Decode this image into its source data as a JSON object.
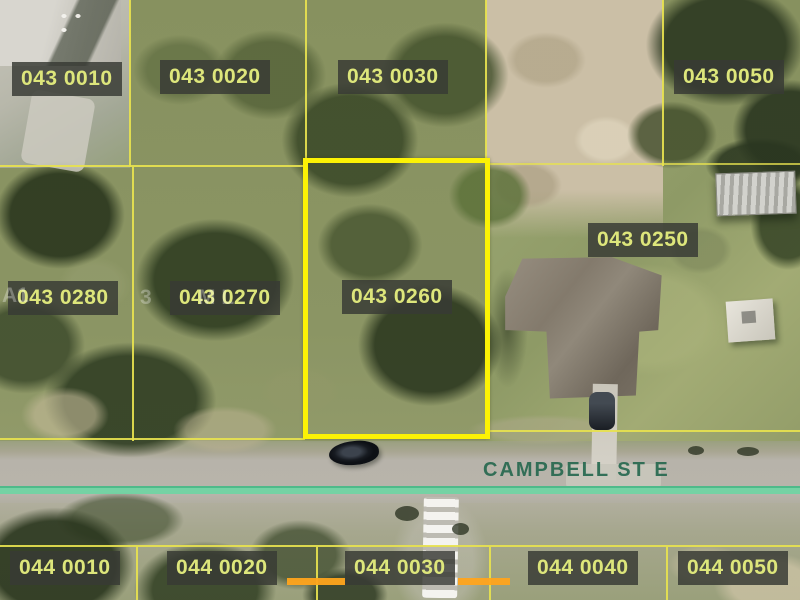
{
  "map": {
    "description": "Aerial parcel map with lot boundaries",
    "street": {
      "name": "CAMPBELL ST E"
    },
    "selected_parcel": {
      "id": "043 0260"
    },
    "parcels": [
      {
        "id": "043 0010"
      },
      {
        "id": "043 0020"
      },
      {
        "id": "043 0030"
      },
      {
        "id": "043 0050"
      },
      {
        "id": "043 0250"
      },
      {
        "id": "043 0280"
      },
      {
        "id": "043 0270"
      },
      {
        "id": "043 0260",
        "selected": true
      },
      {
        "id": "044 0010"
      },
      {
        "id": "044 0020"
      },
      {
        "id": "044 0030"
      },
      {
        "id": "044 0040"
      },
      {
        "id": "044 0050"
      }
    ],
    "watermark": {
      "fragments": [
        "A1",
        "3",
        "M L"
      ]
    },
    "colors": {
      "parcel_line": "#e7e24f",
      "selected_outline": "#fcf205",
      "label_background": "rgba(56,58,53,0.84)",
      "label_text": "#dde67b",
      "street_centerline": "#6ed5a3",
      "street_text": "#26684f",
      "highlight_dash": "#ffa41c"
    }
  }
}
